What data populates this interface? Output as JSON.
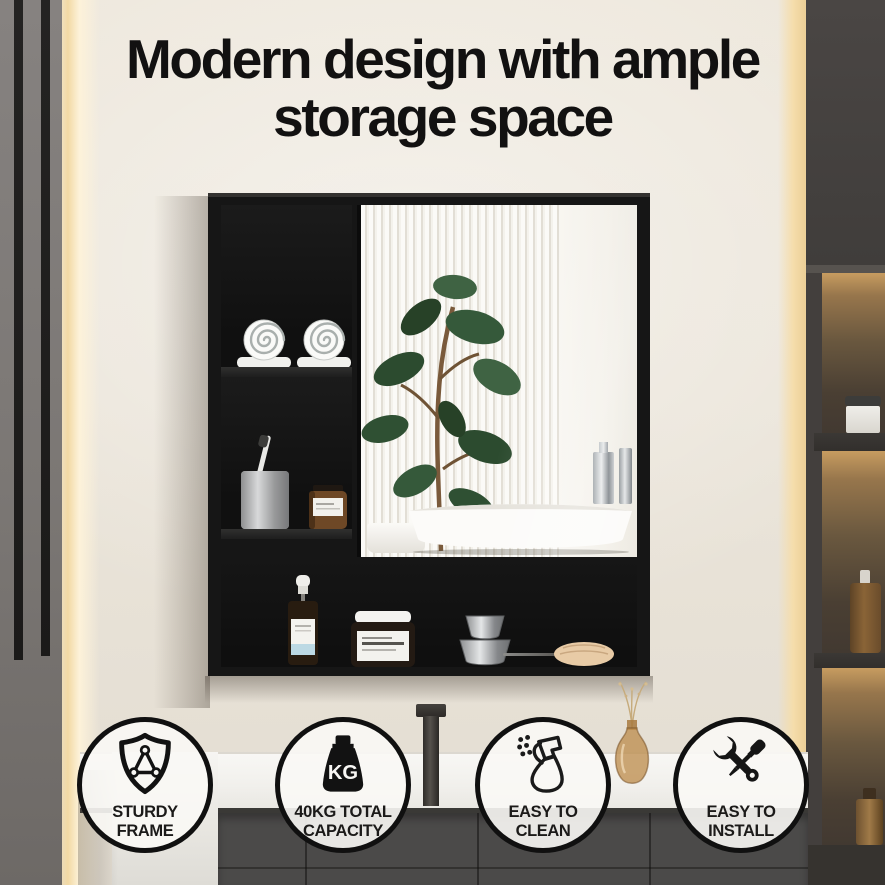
{
  "title": {
    "line1": "Modern design with ample",
    "line2": "storage space"
  },
  "badges": [
    {
      "name": "sturdy-frame",
      "icon": "shield-frame-icon",
      "line1": "STURDY",
      "line2": "FRAME"
    },
    {
      "name": "weight-capacity",
      "icon": "kg-weight-icon",
      "icon_text": "KG",
      "line1": "40KG TOTAL",
      "line2": "CAPACITY"
    },
    {
      "name": "easy-to-clean",
      "icon": "spray-bottle-icon",
      "line1": "EASY TO",
      "line2": "CLEAN"
    },
    {
      "name": "easy-to-install",
      "icon": "wrench-screwdriver-icon",
      "line1": "EASY TO",
      "line2": "INSTALL"
    }
  ],
  "colors": {
    "wall": "#ece6db",
    "glow": "#f7dfae",
    "panel": "#7b7774",
    "stripe": "#1f1e1d",
    "unit": "#433f3d",
    "niche": "#c79c60",
    "cabinet": "#161616",
    "mirror": "#f6f4ef",
    "counter": "#f3f2ee",
    "drawer": "#4b4a49",
    "badgeBg": "#f8f7f4",
    "badgeBorder": "#101010",
    "text": "#121111"
  }
}
